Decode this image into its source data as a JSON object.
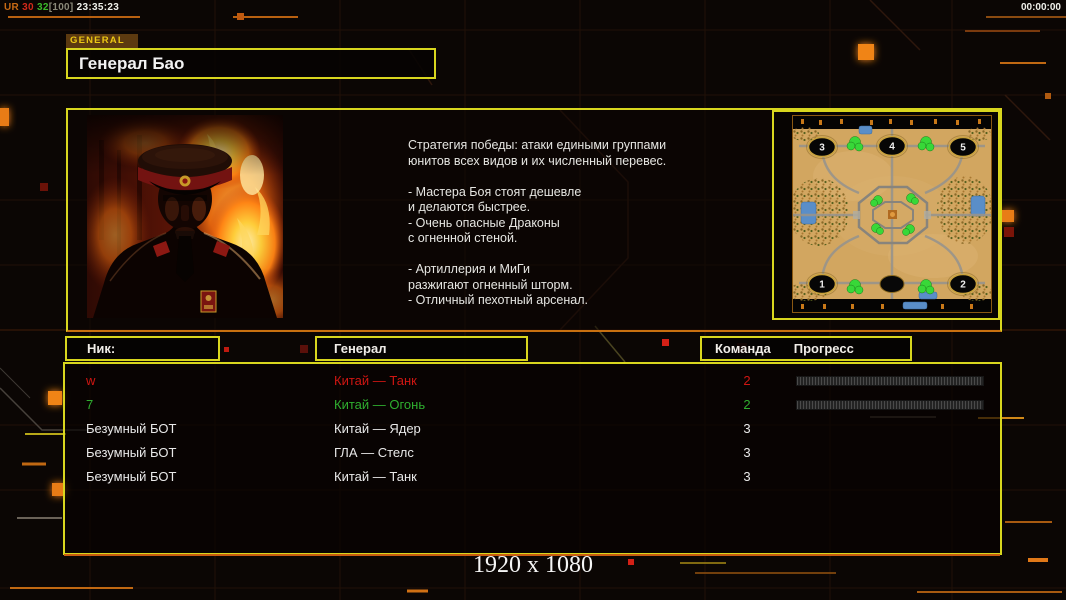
{
  "statusbar": {
    "net_label": "UR",
    "fps": "30",
    "ping": "32",
    "bracket": "[100]",
    "clock": "23:35:23",
    "timer": "00:00:00"
  },
  "header": {
    "tab": "GENERAL",
    "title": "Генерал Бао"
  },
  "panel": {
    "strategy_lines": [
      "Стратегия победы: атаки едиными группами",
      "юнитов всех видов и их численный перевес.",
      "",
      "- Мастера Боя стоят дешевле",
      "и делаются быстрее.",
      "- Очень опасные Драконы",
      "с огненной стеной.",
      "",
      "- Артиллерия и МиГи",
      "разжигают огненный шторм.",
      "- Отличный пехотный арсенал."
    ]
  },
  "minimap": {
    "spawns": [
      "3",
      "4",
      "5",
      "1",
      "2"
    ]
  },
  "table": {
    "headers": {
      "nick": "Ник:",
      "general": "Генерал",
      "team": "Команда",
      "progress": "Прогресс"
    },
    "rows": [
      {
        "nick": "w",
        "general": "Китай — Танк",
        "team": "2",
        "color": "#cf1612",
        "has_progress": true
      },
      {
        "nick": "7",
        "general": "Китай — Огонь",
        "team": "2",
        "color": "#2fae2f",
        "has_progress": true
      },
      {
        "nick": "Безумный БОТ",
        "general": "Китай — Ядер",
        "team": "3",
        "color": "#e8e8e8",
        "has_progress": false
      },
      {
        "nick": "Безумный БОТ",
        "general": "ГЛА — Стелс",
        "team": "3",
        "color": "#e8e8e8",
        "has_progress": false
      },
      {
        "nick": "Безумный БОТ",
        "general": "Китай — Танк",
        "team": "3",
        "color": "#e8e8e8",
        "has_progress": false
      }
    ]
  },
  "footer": {
    "resolution": "1920 x 1080"
  },
  "colors": {
    "border_yellow": "#d8d61e",
    "accent_orange": "#e8821c",
    "row_red": "#cf1612",
    "row_green": "#2fae2f",
    "row_white": "#e8e8e8"
  }
}
